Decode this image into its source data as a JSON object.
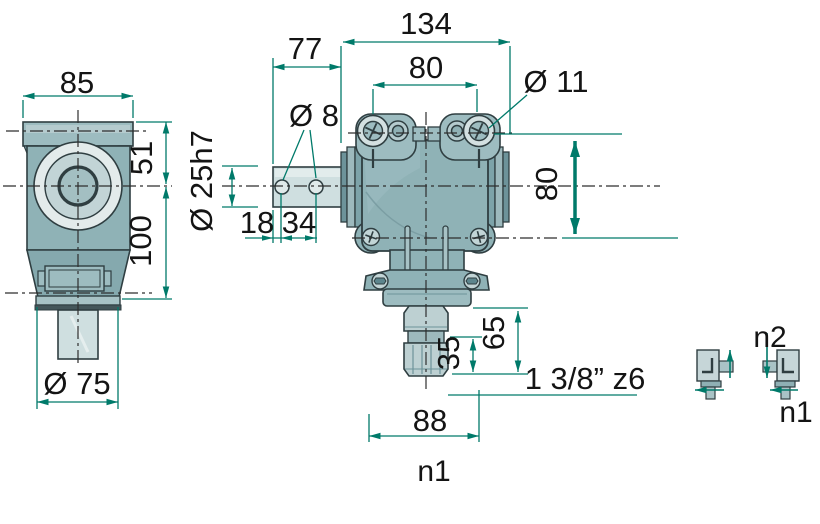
{
  "colors": {
    "dimension_green": "#007a6a",
    "body_teal": "#8fb2b6",
    "outline_dark": "#2f3e41",
    "light_metal": "#cfdfe0",
    "background": "#ffffff"
  },
  "left_view": {
    "housing_width": "85",
    "upper_offset": "51",
    "lower_offset": "100",
    "output_flange_dia": "Ø 75"
  },
  "main_view": {
    "overall_width": "134",
    "input_projection": "77",
    "top_hole_spacing": "80",
    "top_hole_dia": "Ø 11",
    "pin_hole_dia": "Ø 8",
    "input_shaft_dia": "Ø 25h7",
    "pin_hole_end_distance": "18",
    "pin_hole_spacing": "34",
    "vertical_hole_spacing": "80",
    "output_projection": "65",
    "spline_length": "35",
    "output_spline_spec": "1 3/8” z6",
    "base_width": "88",
    "view_label": "n1"
  },
  "rotation_diagram": {
    "input_speed_label": "n2",
    "output_speed_label": "n1"
  }
}
